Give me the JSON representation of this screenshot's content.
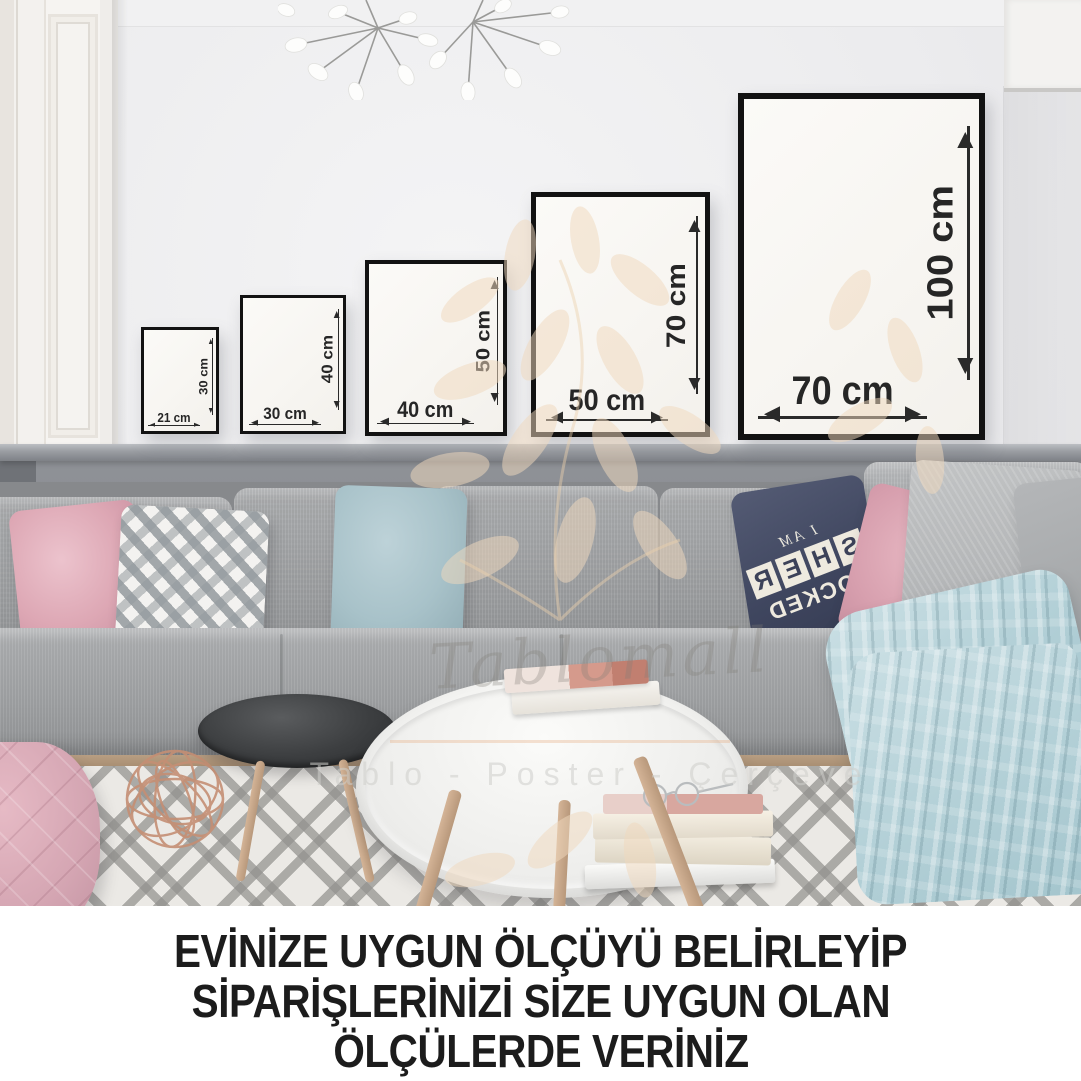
{
  "frames": [
    {
      "width_label": "21 cm",
      "height_label": "30 cm"
    },
    {
      "width_label": "30 cm",
      "height_label": "40 cm"
    },
    {
      "width_label": "40 cm",
      "height_label": "50 cm"
    },
    {
      "width_label": "50 cm",
      "height_label": "70 cm"
    },
    {
      "width_label": "70 cm",
      "height_label": "100 cm"
    }
  ],
  "watermark": {
    "script_text": "Tablomall",
    "tagline": "Tablo - Poster - Çerçeve"
  },
  "sherlock_pillow": {
    "top_text": "I AM",
    "tiles": [
      "S",
      "H",
      "E",
      "R"
    ],
    "bottom_text": "LOCKED"
  },
  "caption": {
    "line1": "EVİNİZE UYGUN ÖLÇÜYÜ BELİRLEYİP",
    "line2": "SİPARİŞLERİNİZİ SİZE UYGUN OLAN",
    "line3": "ÖLÇÜLERDE VERİNİZ"
  },
  "colors": {
    "frame_border": "#121212",
    "dimension_text": "#262626",
    "caption_text": "#1c1c1c",
    "wall": "#ececee",
    "wainscot": "#85888d",
    "sofa_gray": "#9fa1a3",
    "pillow_pink": "#dda7b4",
    "pillow_blue": "#a8c2c9",
    "pillow_navy": "#3f465f",
    "blanket_blue": "#b3d0d7",
    "watermark_peach": "#f0d9bd"
  }
}
